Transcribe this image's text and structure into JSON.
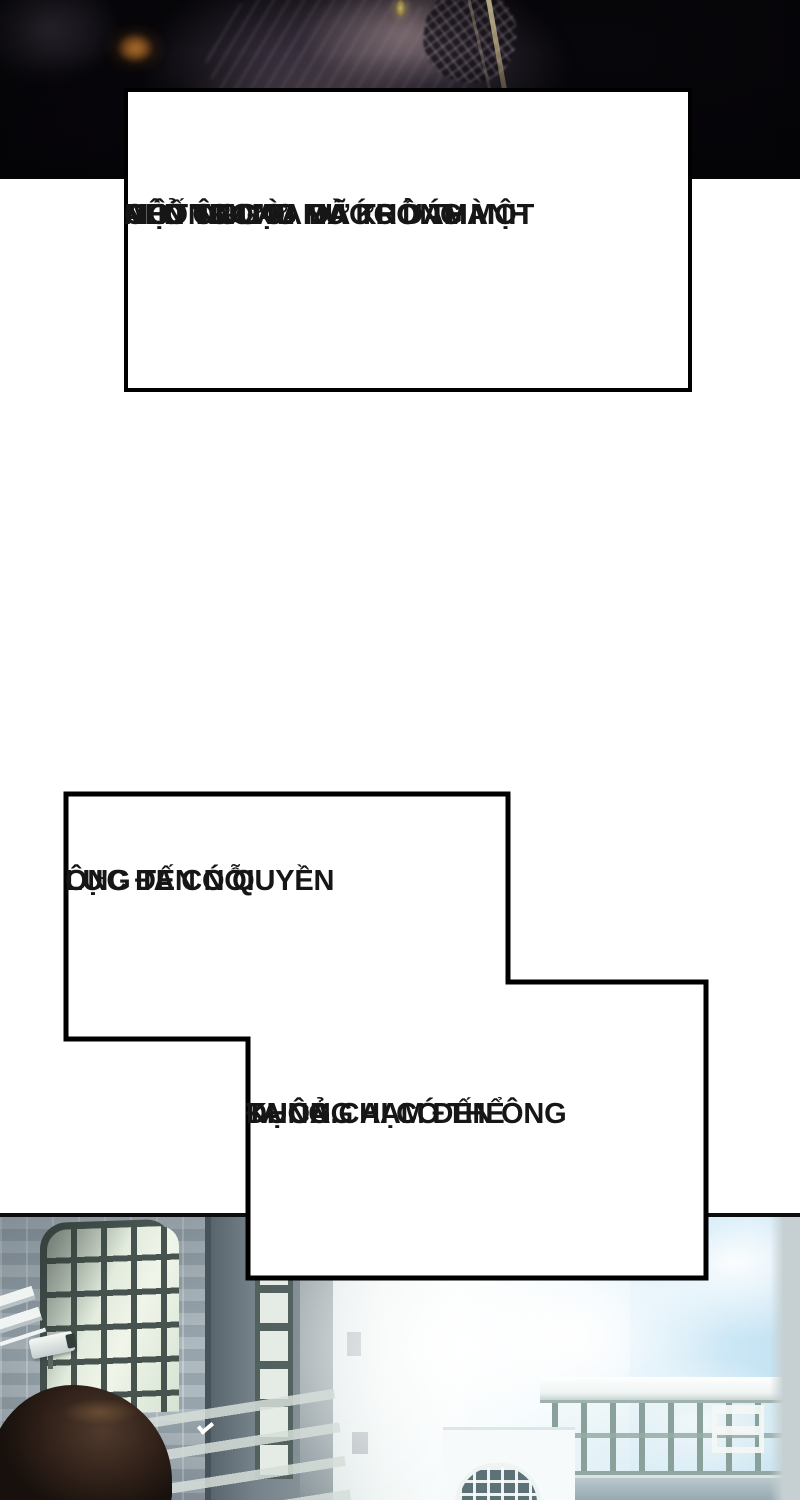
{
  "comic_page": {
    "speech_boxes": [
      {
        "id": "box-1",
        "lines": [
          "NÊN ÔNG TA ĐÃ TRỞ THÀNH",
          "MỘT NGƯỜI MÀ KHÔNG MỘT",
          "AI Ở TRONG NƯỚC DÁM",
          "CHỐNG LẠI."
        ]
      },
      {
        "id": "box-2",
        "lines": [
          "ÔNG TA CÓ QUYỀN",
          "LỰC ĐẾN NỖI"
        ]
      },
      {
        "id": "box-3",
        "lines": [
          "KHÔNG AI CÓ THỂ",
          "ĐỤNG CHẠM ĐẾN ÔNG",
          "TA CẢ."
        ]
      }
    ],
    "artwork": {
      "top_panel": "dark close-up of a figure in a pinstriped suit with a dim ember glow and a light streak",
      "bottom_panel": "bright street scene: brick building with arched grid windows, security camera, walkway bridge with railing, clouds, back of a dark-haired head"
    },
    "colors": {
      "page_background": "#ffffff",
      "box_background": "#ffffff",
      "box_border": "#000000",
      "text": "#161616",
      "sky_blue": "#bfe0f2",
      "window_frame": "#46534e",
      "brick": "#9aa7ae",
      "hair_brown": "#32221a",
      "ember_orange": "#8a5520"
    }
  }
}
